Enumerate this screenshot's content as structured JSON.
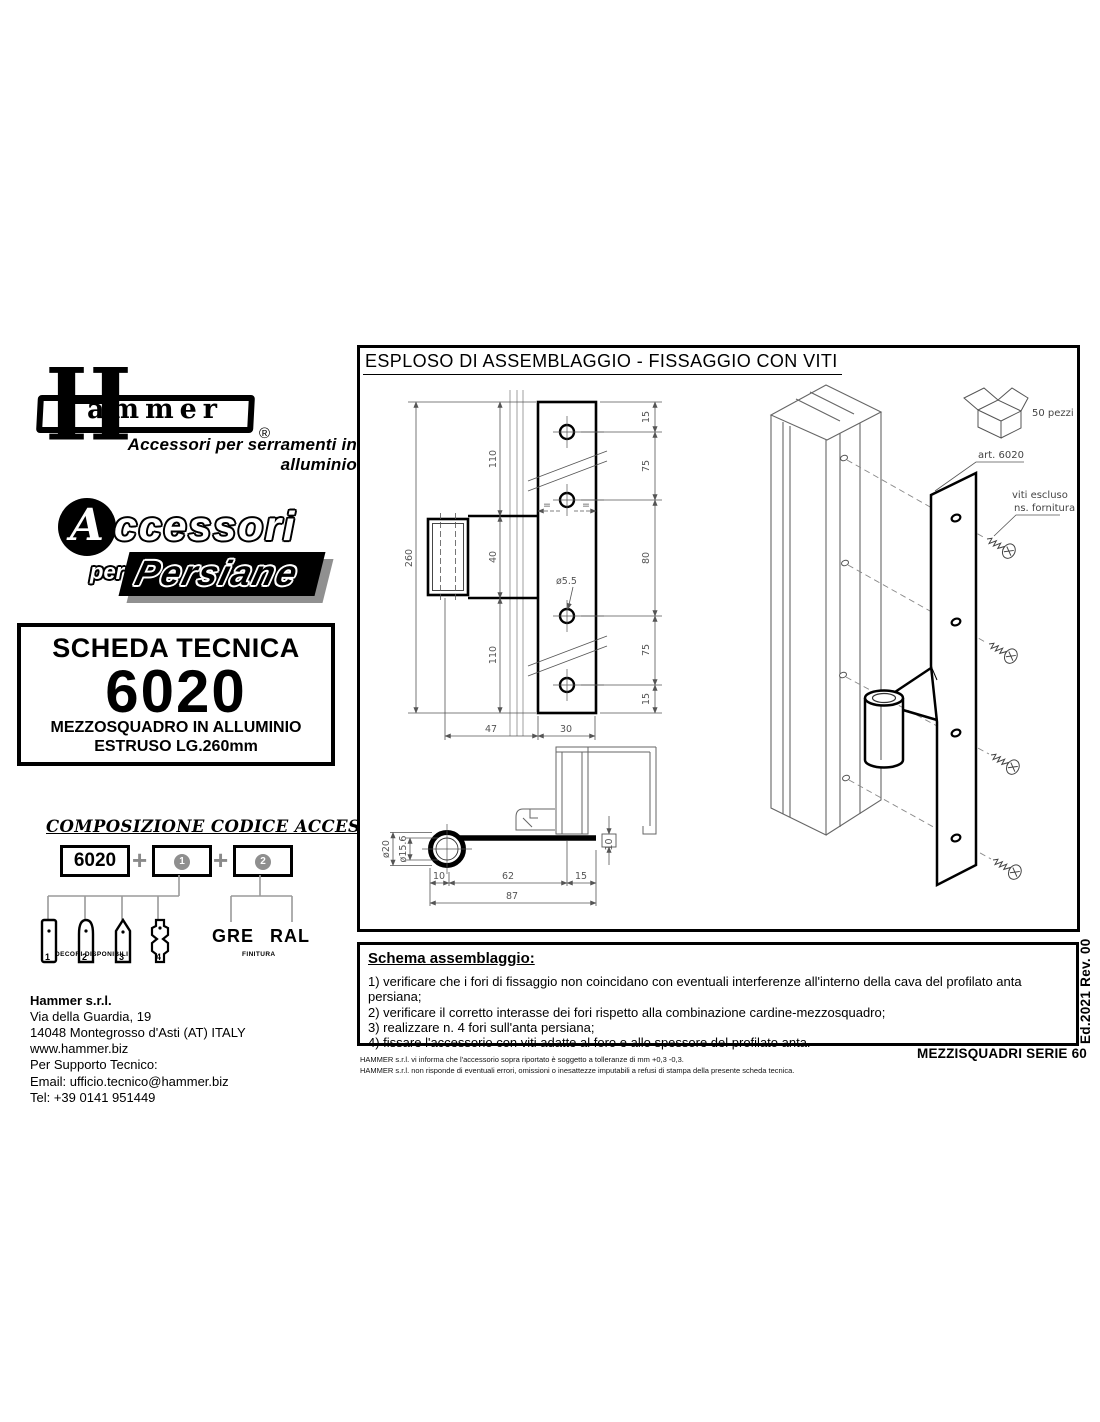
{
  "branding": {
    "logo_word_initial": "H",
    "logo_word_rest": "ammer",
    "registered_mark": "®",
    "tagline": "Accessori per serramenti in alluminio",
    "family_initial": "A",
    "family_word1": "ccessori",
    "family_per": "per",
    "family_word2": "Persiane"
  },
  "tech_sheet": {
    "label": "SCHEDA TECNICA",
    "code": "6020",
    "desc_line1": "MEZZOSQUADRO IN ALLUMINIO",
    "desc_line2": "ESTRUSO LG.260mm"
  },
  "code_composition": {
    "title": "COMPOSIZIONE CODICE ACCESSORIO",
    "base_code": "6020",
    "plus": "+",
    "slot1": "1",
    "slot2": "2",
    "decori_numbers": [
      "1",
      "2",
      "3",
      "4"
    ],
    "decori_caption": "DECORI DISPONIBILI",
    "finish1": "GRE",
    "finish2": "RAL",
    "finish_caption": "FINITURA"
  },
  "company": {
    "name": "Hammer s.r.l.",
    "address1": "Via della Guardia, 19",
    "address2": "14048 Montegrosso d'Asti (AT) ITALY",
    "website": "www.hammer.biz",
    "support": "Per Supporto Tecnico:",
    "email": "Email:  ufficio.tecnico@hammer.biz",
    "phone": "Tel:  +39 0141 951449"
  },
  "drawing": {
    "title": "ESPLOSO DI ASSEMBLAGGIO - FISSAGGIO CON VITI",
    "pack_label": "50 pezzi",
    "part_label": "art. 6020",
    "screw_note1": "viti escluso",
    "screw_note2": "ns. fornitura",
    "dims": {
      "total_length": "260",
      "seg_top": "110",
      "seg_mid": "40",
      "seg_bottom": "110",
      "edge15": "15",
      "pitch75": "75",
      "pitch80": "80",
      "width47": "47",
      "width30": "30",
      "hole_dia": "ø5.5",
      "equal": "=",
      "tube_od": "ø20",
      "tube_id": "ø15.6",
      "sec10": "10",
      "sec62": "62",
      "sec15": "15",
      "sec87": "87",
      "offset10": "10"
    }
  },
  "assembly": {
    "title": "Schema assemblaggio:",
    "steps": [
      "1) verificare che i fori di fissaggio non coincidano con eventuali interferenze all'interno della cava del profilato anta persiana;",
      "2) verificare il corretto interasse dei fori rispetto alla combinazione cardine-mezzosquadro;",
      "3) realizzare n. 4 fori sull'anta persiana;",
      "4) fissare l'accessorio con viti adatte al foro e allo spessore del profilato anta."
    ]
  },
  "footer": {
    "edition": "Ed.2021 Rev. 00",
    "series": "MEZZISQUADRI SERIE 60",
    "disclaimer1": "HAMMER s.r.l. vi informa che l'accessorio sopra riportato è soggetto a tolleranze di mm +0,3 -0,3.",
    "disclaimer2": "HAMMER s.r.l. non risponde di eventuali errori, omissioni o inesattezze imputabili a refusi di stampa della presente scheda tecnica."
  }
}
